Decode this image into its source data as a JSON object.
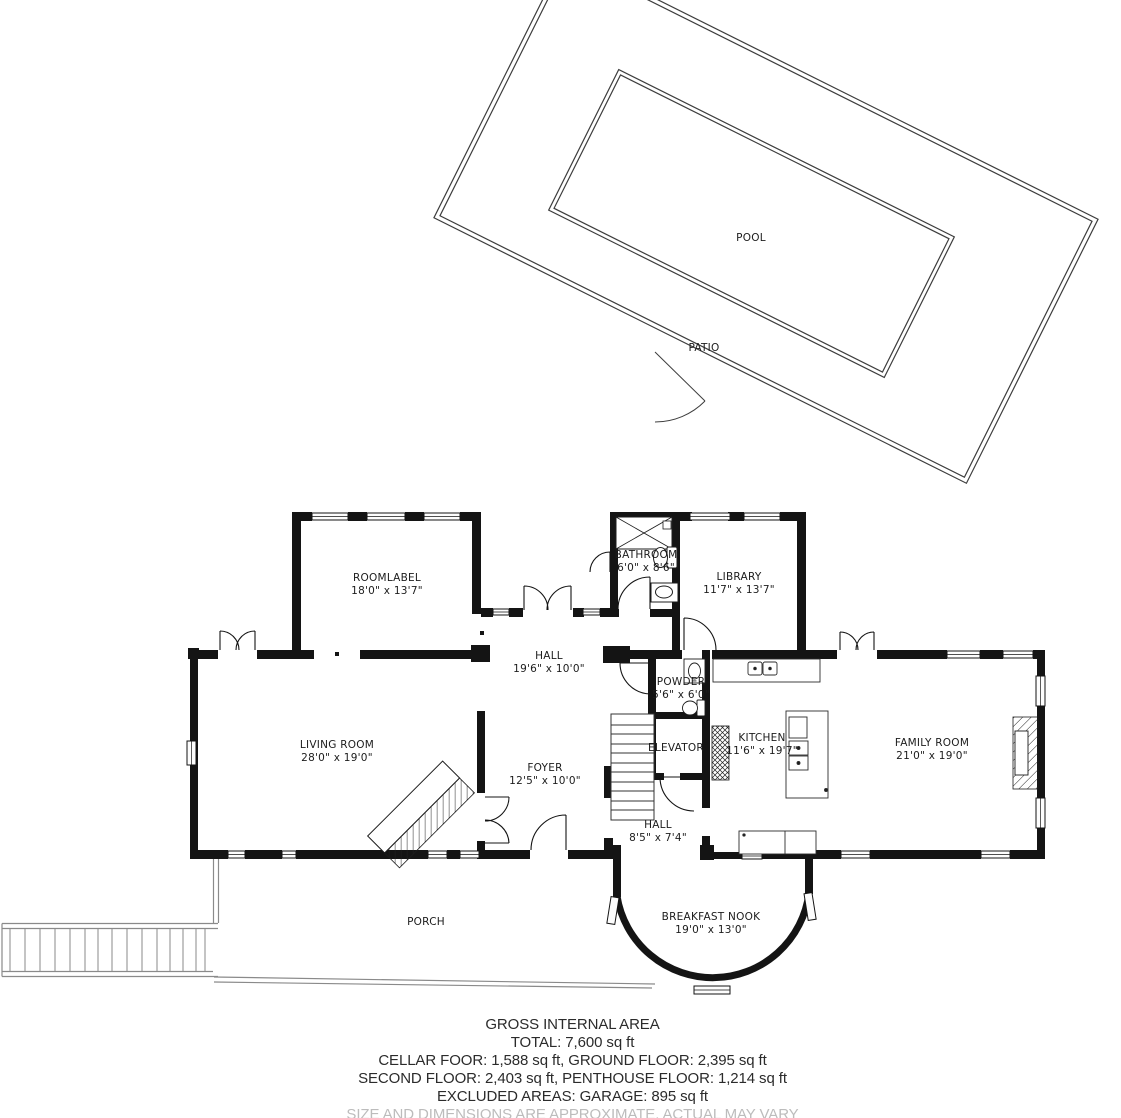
{
  "outdoor": {
    "pool_label": "POOL",
    "patio_label": "PATIO"
  },
  "rooms": {
    "roomlabel": {
      "name": "ROOMLABEL",
      "dims": "18'0\" x 13'7\""
    },
    "bathroom": {
      "name": "BATHROOM",
      "dims": "6'0\" x 8'6\""
    },
    "library": {
      "name": "LIBRARY",
      "dims": "11'7\" x 13'7\""
    },
    "hall_upper": {
      "name": "HALL",
      "dims": "19'6\" x 10'0\""
    },
    "living_room": {
      "name": "LIVING ROOM",
      "dims": "28'0\" x 19'0\""
    },
    "foyer": {
      "name": "FOYER",
      "dims": "12'5\" x 10'0\""
    },
    "powder": {
      "name": "POWDER",
      "dims": "5'6\" x 6'0\""
    },
    "elevator": {
      "name": "ELEVATOR"
    },
    "kitchen": {
      "name": "KITCHEN",
      "dims": "11'6\" x 19'7\""
    },
    "family_room": {
      "name": "FAMILY ROOM",
      "dims": "21'0\" x 19'0\""
    },
    "hall_lower": {
      "name": "HALL",
      "dims": "8'5\" x 7'4\""
    },
    "breakfast_nook": {
      "name": "BREAKFAST NOOK",
      "dims": "19'0\" x 13'0\""
    },
    "porch": {
      "name": "PORCH"
    }
  },
  "summary": {
    "title": "GROSS INTERNAL AREA",
    "total": "TOTAL: 7,600 sq ft",
    "floors_line_1": "CELLAR FOOR: 1,588 sq ft, GROUND FLOOR: 2,395 sq ft",
    "floors_line_2": "SECOND FLOOR: 2,403 sq ft, PENTHOUSE FLOOR: 1,214 sq ft",
    "excluded": "EXCLUDED AREAS: GARAGE: 895 sq ft",
    "disclaimer": "SIZE AND DIMENSIONS ARE APPROXIMATE, ACTUAL MAY VARY"
  },
  "colors": {
    "wall": "#141414",
    "thin_line": "#3d3d3d",
    "porch_line": "#8a8a8a",
    "label_text": "#1c1c1c",
    "summary_text": "#2b2b2b",
    "disclaimer_text": "#bcbcbc",
    "background": "#ffffff"
  }
}
